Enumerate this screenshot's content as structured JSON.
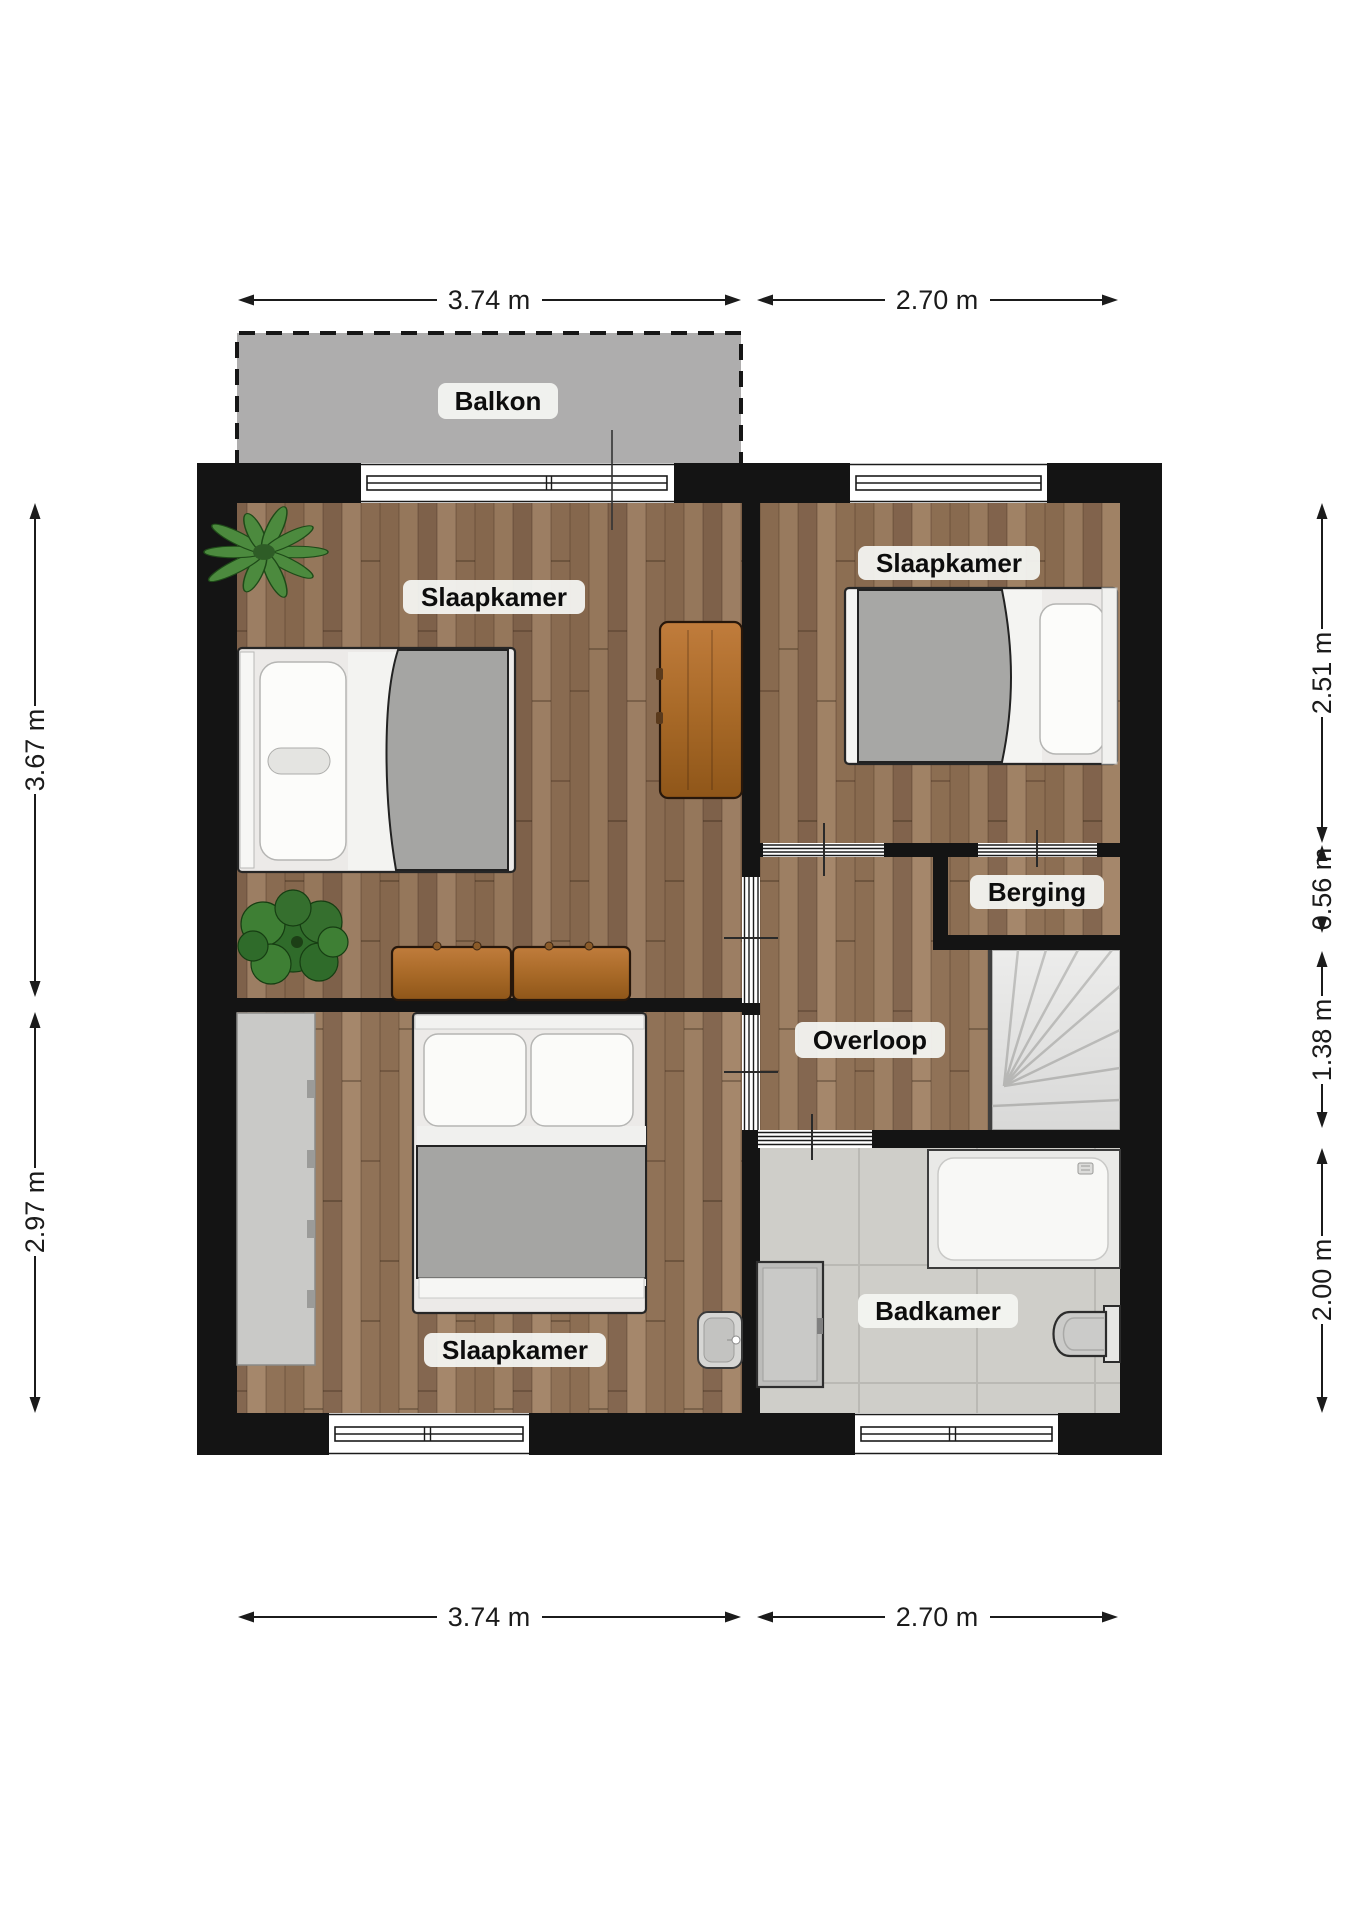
{
  "floorplan": {
    "rooms": {
      "balcony": "Balkon",
      "bedroom_top_left": "Slaapkamer",
      "bedroom_top_right": "Slaapkamer",
      "storage": "Berging",
      "landing": "Overloop",
      "bathroom": "Badkamer",
      "bedroom_bottom": "Slaapkamer"
    },
    "dimensions": {
      "top_left": "3.74 m",
      "top_right": "2.70 m",
      "bottom_left": "3.74 m",
      "bottom_right": "2.70 m",
      "left_upper": "3.67 m",
      "left_lower": "2.97 m",
      "right_bedroom": "2.51 m",
      "right_storage": "0.56 m",
      "right_stairs": "1.38 m",
      "right_bathroom": "2.00 m"
    },
    "palette": {
      "wall": "#141414",
      "wood_floor": "#93755a",
      "balcony_gray": "#aeadad",
      "tile_gray": "#cfcec9",
      "duvet_gray": "#a5a5a3",
      "furniture_wood": "#b0722f",
      "plant_green": "#3e7f34",
      "label_bg": "#f3f4f1"
    }
  }
}
